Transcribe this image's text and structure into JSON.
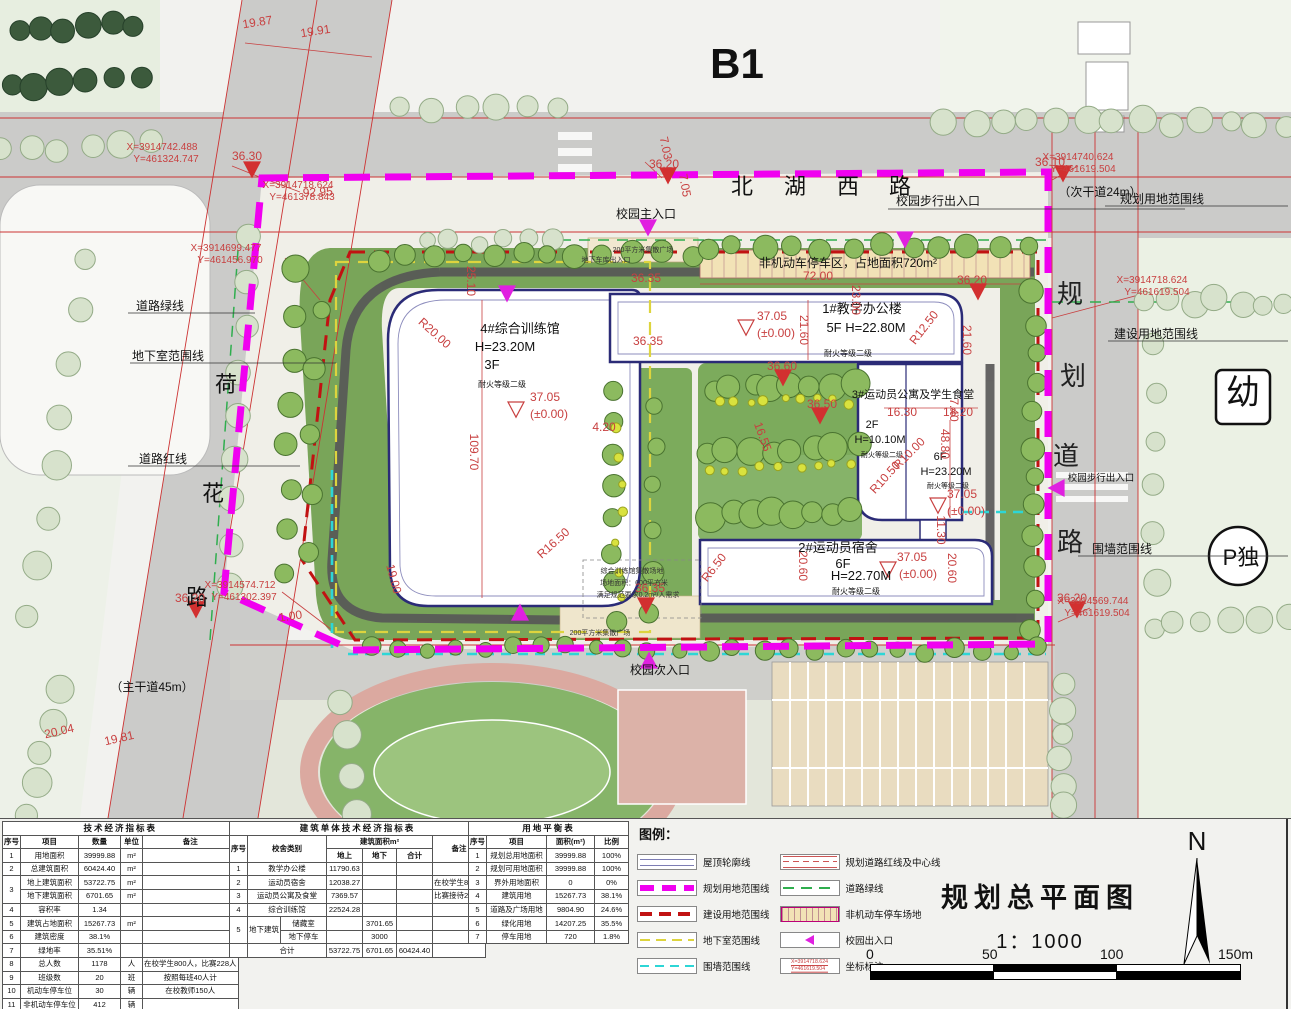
{
  "sheet": {
    "area_label": "B1"
  },
  "title_block": {
    "title": "规划总平面图",
    "scale": "1：1000"
  },
  "north_label": "N",
  "scale_bar": {
    "labels": [
      "0",
      "50",
      "100",
      "150m"
    ]
  },
  "colors": {
    "boundary_magenta": "#f000f0",
    "construction_red": "#c11212",
    "basement_yellow": "#ddd43e",
    "wall_cyan": "#2dd6d6",
    "roofline_blue": "#7d7db4",
    "green_line": "#2fae4e",
    "dim_red": "#c84040"
  },
  "legend": {
    "title": "图例：",
    "items": [
      {
        "type": "roofline",
        "label": "屋顶轮廓线"
      },
      {
        "type": "magenta",
        "label": "规划用地范围线"
      },
      {
        "type": "red",
        "label": "建设用地范围线"
      },
      {
        "type": "yellow",
        "label": "地下室范围线"
      },
      {
        "type": "cyan",
        "label": "围墙范围线"
      },
      {
        "type": "roadline",
        "label": "规划道路红线及中心线"
      },
      {
        "type": "green",
        "label": "道路绿线"
      },
      {
        "type": "hatch",
        "label": "非机动车停车场地"
      },
      {
        "type": "entry",
        "label": "校园出入口"
      },
      {
        "type": "coord",
        "label": "坐标标注"
      }
    ],
    "coord_sample": {
      "line1": "X=3914718.624",
      "line2": "Y=461619.504"
    }
  },
  "tables": [
    {
      "id": "tech-economic-table",
      "title": "技术经济指标表",
      "header": [
        [
          "序号",
          "项目",
          "数量",
          "单位",
          "备注"
        ]
      ],
      "rows": [
        [
          "1",
          "用地面积",
          "39999.88",
          "m²",
          ""
        ],
        [
          "2",
          "总建筑面积",
          "60424.40",
          "m²",
          ""
        ],
        [
          {
            "t": "3",
            "rs": 2
          },
          "地上建筑面积",
          "53722.75",
          "m²",
          ""
        ],
        [
          "地下建筑面积",
          "6701.65",
          "m²",
          ""
        ],
        [
          "4",
          "容积率",
          "1.34",
          "",
          ""
        ],
        [
          "5",
          "建筑占地面积",
          "15267.73",
          "m²",
          ""
        ],
        [
          "6",
          "建筑密度",
          "38.1%",
          "",
          ""
        ],
        [
          "7",
          "绿地率",
          "35.51%",
          "",
          ""
        ],
        [
          "8",
          "总人数",
          "1178",
          "人",
          "在校学生800人，比赛228人"
        ],
        [
          "9",
          "班级数",
          "20",
          "班",
          "按照每班40人计"
        ],
        [
          "10",
          "机动车停车位",
          "30",
          "辆",
          "在校教师150人"
        ],
        [
          "11",
          "非机动车停车位",
          "412",
          "辆",
          ""
        ]
      ],
      "col_widths": [
        16,
        58,
        42,
        22,
        86
      ]
    },
    {
      "id": "building-indicator-table",
      "title": "建筑单体技术经济指标表",
      "header": [
        [
          {
            "t": "序号",
            "rs": 2
          },
          {
            "t": "校舍类别",
            "rs": 2,
            "cs": 2
          },
          {
            "t": "建筑面积m²",
            "cs": 3
          },
          {
            "t": "备注",
            "rs": 2
          }
        ],
        [
          "地上",
          "地下",
          "合计"
        ]
      ],
      "rows": [
        [
          "1",
          {
            "t": "教学办公楼",
            "cs": 2
          },
          "11790.63",
          "",
          "",
          ""
        ],
        [
          "2",
          {
            "t": "运动员宿舍",
            "cs": 2
          },
          "12038.27",
          "",
          "",
          "在校学生800人"
        ],
        [
          "3",
          {
            "t": "运动员公寓及食堂",
            "cs": 2
          },
          "7369.57",
          "",
          "",
          "比赛接待228人"
        ],
        [
          "4",
          {
            "t": "综合训练馆",
            "cs": 2
          },
          "22524.28",
          "",
          "",
          ""
        ],
        [
          {
            "t": "5",
            "rs": 2
          },
          {
            "t": "地下建筑",
            "rs": 2
          },
          "储藏室",
          "",
          "3701.65",
          "",
          ""
        ],
        [
          "地下停车",
          "",
          "3000",
          "",
          ""
        ],
        [
          "",
          {
            "t": "合计",
            "cs": 2
          },
          "53722.75",
          "6701.65",
          "60424.40",
          ""
        ]
      ],
      "col_widths": [
        14,
        26,
        46,
        36,
        34,
        36,
        44
      ]
    },
    {
      "id": "land-balance-table",
      "title": "用地平衡表",
      "header": [
        [
          "序号",
          "项目",
          "面积(m²)",
          "比例"
        ]
      ],
      "rows": [
        [
          "1",
          "规划总用地面积",
          "39999.88",
          "100%"
        ],
        [
          "2",
          "规划可用地面积",
          "39999.88",
          "100%"
        ],
        [
          "3",
          "界外用地面积",
          "0",
          "0%"
        ],
        [
          "4",
          "建筑用地",
          "15267.73",
          "38.1%"
        ],
        [
          "5",
          "道路及广场用地",
          "9804.90",
          "24.6%"
        ],
        [
          "6",
          "绿化用地",
          "14207.25",
          "35.5%"
        ],
        [
          "7",
          "停车用地",
          "720",
          "1.8%"
        ]
      ],
      "col_widths": [
        18,
        60,
        48,
        34
      ]
    }
  ],
  "plan": {
    "annotations": [
      {
        "t": "B1",
        "x": 737,
        "y": 78,
        "c": "huge"
      },
      {
        "t": "北",
        "x": 742,
        "y": 194,
        "c": "road"
      },
      {
        "t": "湖",
        "x": 795,
        "y": 194,
        "c": "road"
      },
      {
        "t": "西",
        "x": 848,
        "y": 194,
        "c": "road"
      },
      {
        "t": "路",
        "x": 900,
        "y": 194,
        "c": "road"
      },
      {
        "t": "（次干道24m）",
        "x": 1100,
        "y": 196,
        "c": "label"
      },
      {
        "t": "规划用地范围线",
        "x": 1162,
        "y": 203,
        "c": "label"
      },
      {
        "t": "校园步行出入口",
        "x": 938,
        "y": 205,
        "c": "label"
      },
      {
        "t": "校园主入口",
        "x": 646,
        "y": 218,
        "c": "label"
      },
      {
        "t": "200平方米集散广场",
        "x": 643,
        "y": 252,
        "c": "tiny"
      },
      {
        "t": "地下车库出入口",
        "x": 606,
        "y": 262,
        "c": "tiny"
      },
      {
        "t": "非机动车停车区，占地面积720m²",
        "x": 848,
        "y": 267,
        "c": "label"
      },
      {
        "t": "道路绿线",
        "x": 160,
        "y": 310,
        "c": "label"
      },
      {
        "t": "地下室范围线",
        "x": 168,
        "y": 360,
        "c": "label"
      },
      {
        "t": "荷",
        "x": 226,
        "y": 392,
        "c": "road"
      },
      {
        "t": "道路红线",
        "x": 163,
        "y": 463,
        "c": "label"
      },
      {
        "t": "花",
        "x": 213,
        "y": 501,
        "c": "road"
      },
      {
        "t": "路",
        "x": 197,
        "y": 605,
        "c": "road"
      },
      {
        "t": "（主干道45m）",
        "x": 152,
        "y": 691,
        "c": "label"
      },
      {
        "t": "规",
        "x": 1070,
        "y": 303,
        "c": "rg"
      },
      {
        "t": "划",
        "x": 1073,
        "y": 385,
        "c": "rg"
      },
      {
        "t": "道",
        "x": 1066,
        "y": 465,
        "c": "rg"
      },
      {
        "t": "路",
        "x": 1070,
        "y": 551,
        "c": "rg"
      },
      {
        "t": "幼",
        "x": 1243,
        "y": 404,
        "c": "big2"
      },
      {
        "t": "P独",
        "x": 1241,
        "y": 565,
        "c": "p"
      },
      {
        "t": "建设用地范围线",
        "x": 1156,
        "y": 338,
        "c": "label"
      },
      {
        "t": "围墙范围线",
        "x": 1122,
        "y": 553,
        "c": "label"
      },
      {
        "t": "校园步行出入口",
        "x": 1101,
        "y": 481,
        "c": "small9"
      },
      {
        "t": "4#综合训练馆",
        "x": 520,
        "y": 333,
        "c": "bldg"
      },
      {
        "t": "H=23.20M",
        "x": 505,
        "y": 351,
        "c": "bldg"
      },
      {
        "t": "3F",
        "x": 492,
        "y": 369,
        "c": "bldg"
      },
      {
        "t": "耐火等级二级",
        "x": 502,
        "y": 387,
        "c": "small"
      },
      {
        "t": "1#教学办公楼",
        "x": 862,
        "y": 313,
        "c": "bldg"
      },
      {
        "t": "5F  H=22.80M",
        "x": 866,
        "y": 332,
        "c": "bldg"
      },
      {
        "t": "耐火等级二级",
        "x": 848,
        "y": 356,
        "c": "small"
      },
      {
        "t": "3#运动员公寓及学生食堂",
        "x": 913,
        "y": 398,
        "c": "b11"
      },
      {
        "t": "2F",
        "x": 872,
        "y": 428,
        "c": "b11"
      },
      {
        "t": "H=10.10M",
        "x": 880,
        "y": 443,
        "c": "b11"
      },
      {
        "t": "耐火等级二级",
        "x": 882,
        "y": 457,
        "c": "small7"
      },
      {
        "t": "6F",
        "x": 940,
        "y": 460,
        "c": "b11"
      },
      {
        "t": "H=23.20M",
        "x": 946,
        "y": 475,
        "c": "b11"
      },
      {
        "t": "耐火等级二级",
        "x": 948,
        "y": 488,
        "c": "small7"
      },
      {
        "t": "2#运动员宿舍",
        "x": 838,
        "y": 552,
        "c": "bldg"
      },
      {
        "t": "6F",
        "x": 843,
        "y": 568,
        "c": "bldg"
      },
      {
        "t": "H=22.70M",
        "x": 861,
        "y": 580,
        "c": "bldg"
      },
      {
        "t": "耐火等级二级",
        "x": 856,
        "y": 594,
        "c": "small"
      },
      {
        "t": "综合训练馆集散场地",
        "x": 632,
        "y": 573,
        "c": "tiny"
      },
      {
        "t": "场地面积：600平方米",
        "x": 634,
        "y": 585,
        "c": "tiny"
      },
      {
        "t": "满足规范要求0.2m²/人需求",
        "x": 638,
        "y": 597,
        "c": "tiny"
      },
      {
        "t": "校园次入口",
        "x": 660,
        "y": 674,
        "c": "label"
      },
      {
        "t": "200平方米集散广场",
        "x": 600,
        "y": 635,
        "c": "tiny"
      },
      {
        "t": "X=3914742.488",
        "x": 162,
        "y": 150,
        "c": "coord"
      },
      {
        "t": "Y=461324.747",
        "x": 166,
        "y": 162,
        "c": "coord"
      },
      {
        "t": "X=3914718.624",
        "x": 298,
        "y": 188,
        "c": "coord"
      },
      {
        "t": "Y=461378.843",
        "x": 302,
        "y": 200,
        "c": "coord"
      },
      {
        "t": "X=3914699.477",
        "x": 226,
        "y": 251,
        "c": "coord"
      },
      {
        "t": "Y=461456.970",
        "x": 230,
        "y": 263,
        "c": "coord"
      },
      {
        "t": "X=3914740.624",
        "x": 1078,
        "y": 160,
        "c": "coord"
      },
      {
        "t": "Y=461619.504",
        "x": 1083,
        "y": 172,
        "c": "coord"
      },
      {
        "t": "X=3914718.624",
        "x": 1152,
        "y": 283,
        "c": "coord"
      },
      {
        "t": "Y=461619.504",
        "x": 1157,
        "y": 295,
        "c": "coord"
      },
      {
        "t": "X=3914574.712",
        "x": 240,
        "y": 588,
        "c": "coord"
      },
      {
        "t": "Y=461302.397",
        "x": 244,
        "y": 600,
        "c": "coord"
      },
      {
        "t": "X=3914569.744",
        "x": 1093,
        "y": 604,
        "c": "coord"
      },
      {
        "t": "Y=461619.504",
        "x": 1097,
        "y": 616,
        "c": "coord"
      },
      {
        "t": "36.30",
        "x": 247,
        "y": 160,
        "c": "dim"
      },
      {
        "t": "36.10",
        "x": 1050,
        "y": 166,
        "c": "dim"
      },
      {
        "t": "36.20",
        "x": 664,
        "y": 168,
        "c": "dim"
      },
      {
        "t": "36.20",
        "x": 972,
        "y": 284,
        "c": "dim"
      },
      {
        "t": "36.20",
        "x": 190,
        "y": 602,
        "c": "dim"
      },
      {
        "t": "36.20",
        "x": 1072,
        "y": 602,
        "c": "dim"
      },
      {
        "t": "36.35",
        "x": 646,
        "y": 282,
        "c": "dim"
      },
      {
        "t": "36.35",
        "x": 650,
        "y": 592,
        "c": "dim"
      },
      {
        "t": "36.60",
        "x": 782,
        "y": 370,
        "c": "dim"
      },
      {
        "t": "36.50",
        "x": 822,
        "y": 408,
        "c": "dim"
      },
      {
        "t": "19.87",
        "x": 258,
        "y": 26,
        "c": "dim",
        "r": -9
      },
      {
        "t": "19.91",
        "x": 316,
        "y": 35,
        "c": "dim",
        "r": -9
      },
      {
        "t": "92.95",
        "x": 318,
        "y": 196,
        "c": "dim",
        "r": -3
      },
      {
        "t": "7.03",
        "x": 662,
        "y": 149,
        "c": "dim",
        "r": 78
      },
      {
        "t": "7.05",
        "x": 681,
        "y": 186,
        "c": "dim",
        "r": 80
      },
      {
        "t": "72.00",
        "x": 818,
        "y": 280,
        "c": "dim"
      },
      {
        "t": "23.00",
        "x": 852,
        "y": 300,
        "c": "dim",
        "r": 90
      },
      {
        "t": "25.10",
        "x": 467,
        "y": 281,
        "c": "dim",
        "r": 90
      },
      {
        "t": "R20.00",
        "x": 432,
        "y": 336,
        "c": "dim",
        "r": 42
      },
      {
        "t": "109.70",
        "x": 470,
        "y": 452,
        "c": "dim",
        "r": 90
      },
      {
        "t": "R16.50",
        "x": 556,
        "y": 546,
        "c": "dim",
        "r": -42
      },
      {
        "t": "19.00",
        "x": 390,
        "y": 580,
        "c": "dim",
        "r": 75
      },
      {
        "t": "1.00",
        "x": 291,
        "y": 620,
        "c": "dim",
        "r": -8
      },
      {
        "t": "R6.50",
        "x": 717,
        "y": 570,
        "c": "dim",
        "r": -52
      },
      {
        "t": "R12.50",
        "x": 927,
        "y": 330,
        "c": "dim",
        "r": -52
      },
      {
        "t": "R10.00",
        "x": 912,
        "y": 456,
        "c": "dim",
        "r": -45
      },
      {
        "t": "R10.50",
        "x": 888,
        "y": 480,
        "c": "dim",
        "r": -48
      },
      {
        "t": "21.60",
        "x": 800,
        "y": 330,
        "c": "dim",
        "r": 90
      },
      {
        "t": "21.60",
        "x": 963,
        "y": 340,
        "c": "dim",
        "r": 90
      },
      {
        "t": "7.40",
        "x": 950,
        "y": 410,
        "c": "dim",
        "r": 90
      },
      {
        "t": "16.30",
        "x": 902,
        "y": 416,
        "c": "dim"
      },
      {
        "t": "18.20",
        "x": 958,
        "y": 416,
        "c": "dim"
      },
      {
        "t": "48.80",
        "x": 941,
        "y": 444,
        "c": "dim",
        "r": 90
      },
      {
        "t": "11.30",
        "x": 937,
        "y": 530,
        "c": "dim",
        "r": 90
      },
      {
        "t": "20.60",
        "x": 799,
        "y": 566,
        "c": "dim",
        "r": 90
      },
      {
        "t": "20.60",
        "x": 948,
        "y": 568,
        "c": "dim",
        "r": 90
      },
      {
        "t": "16.55",
        "x": 759,
        "y": 438,
        "c": "dim",
        "r": 70
      },
      {
        "t": "4.20",
        "x": 604,
        "y": 431,
        "c": "dim"
      },
      {
        "t": "20.04",
        "x": 60,
        "y": 735,
        "c": "dim",
        "r": -13
      },
      {
        "t": "19.81",
        "x": 120,
        "y": 742,
        "c": "dim",
        "r": -13
      },
      {
        "t": "37.05",
        "x": 545,
        "y": 401,
        "c": "dim"
      },
      {
        "t": "(±0.00)",
        "x": 549,
        "y": 418,
        "c": "dim"
      },
      {
        "t": "37.05",
        "x": 772,
        "y": 320,
        "c": "dim"
      },
      {
        "t": "(±0.00)",
        "x": 776,
        "y": 337,
        "c": "dim"
      },
      {
        "t": "37.05",
        "x": 962,
        "y": 498,
        "c": "dim"
      },
      {
        "t": "(±0.00)",
        "x": 966,
        "y": 515,
        "c": "dim"
      },
      {
        "t": "37.05",
        "x": 912,
        "y": 561,
        "c": "dim"
      },
      {
        "t": "(±0.00)",
        "x": 918,
        "y": 578,
        "c": "dim"
      },
      {
        "t": "36.35",
        "x": 648,
        "y": 345,
        "c": "dim"
      }
    ]
  }
}
